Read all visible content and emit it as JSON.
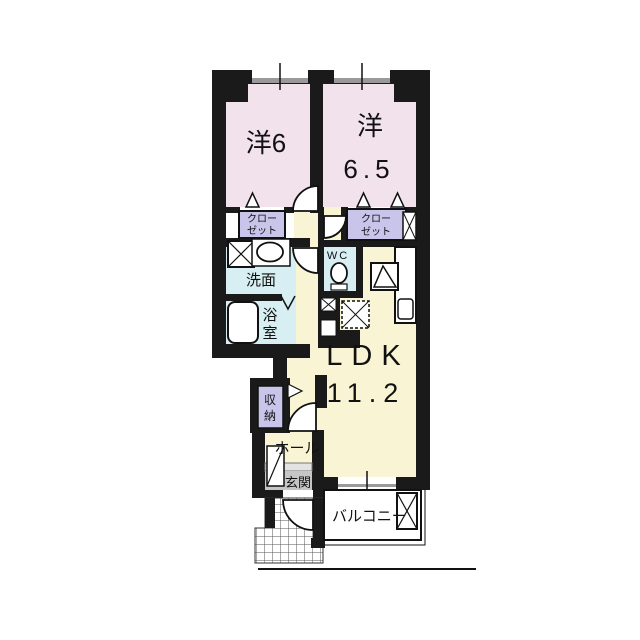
{
  "plan": {
    "title": "apartment-floor-plan",
    "rooms": {
      "bedroom1": {
        "label": "洋6"
      },
      "bedroom2": {
        "label_line1": "洋",
        "label_line2": "6.5"
      },
      "ldk": {
        "label_line1": "LDK",
        "label_line2": "11.2"
      },
      "closet1": {
        "line1": "クロー",
        "line2": "ゼット"
      },
      "closet2": {
        "line1": "クロー",
        "line2": "ゼット"
      },
      "washroom": {
        "label": "洗面"
      },
      "bathroom": {
        "char1": "浴",
        "char2": "室"
      },
      "wc": {
        "label": "WC"
      },
      "storage": {
        "char1": "収",
        "char2": "納"
      },
      "hall": {
        "label": "ホール"
      },
      "entrance": {
        "label": "玄関"
      },
      "balcony": {
        "label": "バルコニー"
      }
    },
    "colors": {
      "wall": "#1a1a1a",
      "bedroom_fill": "#f2e2ec",
      "closet_fill": "#c9c5ea",
      "water_fill": "#d7eef2",
      "ldk_fill": "#f8f4d4",
      "entrance_fill": "#c6c6c6",
      "window_gray": "#9a9a9a",
      "tile_line": "#555555"
    }
  }
}
